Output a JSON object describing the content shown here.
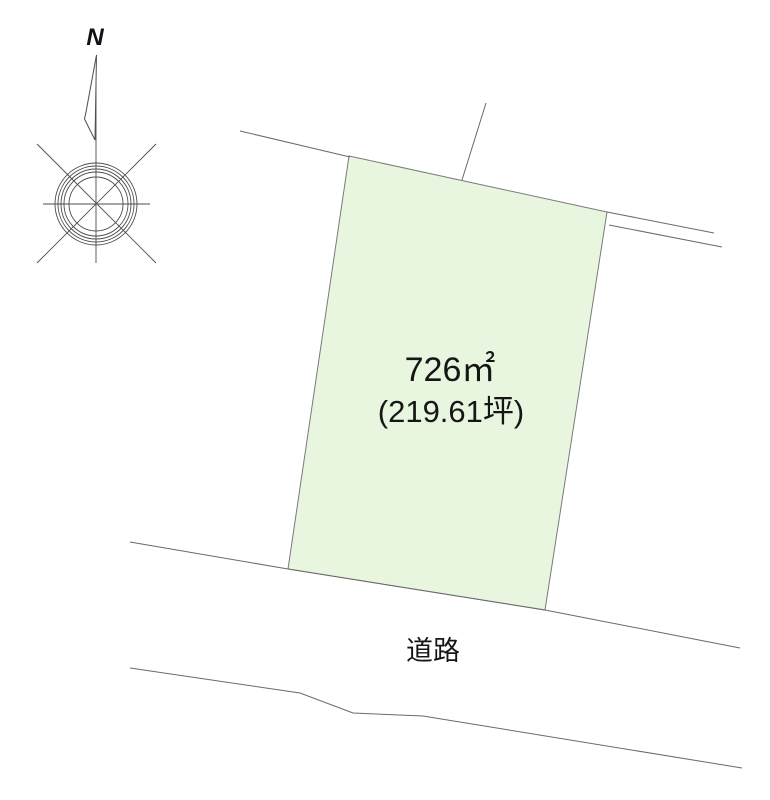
{
  "title": "land-plot-survey-diagram",
  "labels": {
    "north": "N",
    "area_m2": "726㎡",
    "area_tsubo": "(219.61坪)",
    "road": "道路"
  },
  "parcel": {
    "area_m2_value": 726,
    "area_tsubo_value": 219.61,
    "points": "349,156 607,212 545,610 288,569"
  },
  "compass": {
    "center_x": 96,
    "center_y": 204,
    "ring_radii": [
      41,
      38,
      35,
      32,
      27
    ]
  },
  "colors": {
    "background": "#ffffff",
    "parcel_fill": "#e9f6df",
    "parcel_stroke": "#7a7a7a",
    "boundary_line": "#6a6a6a",
    "text": "#161616"
  }
}
